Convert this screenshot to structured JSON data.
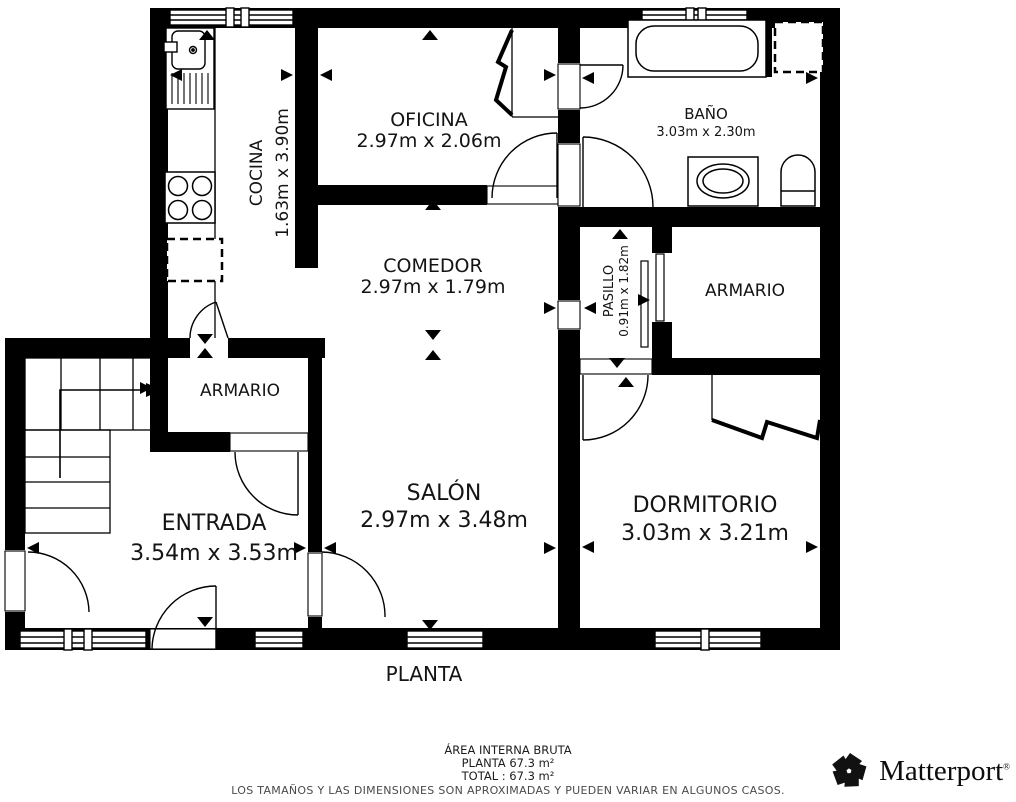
{
  "plan": {
    "title": "PLANTA",
    "rooms": {
      "cocina": {
        "name": "COCINA",
        "dims": "1.63m x 3.90m"
      },
      "oficina": {
        "name": "OFICINA",
        "dims": "2.97m x 2.06m"
      },
      "bano": {
        "name": "BAÑO",
        "dims": "3.03m x 2.30m"
      },
      "comedor": {
        "name": "COMEDOR",
        "dims": "2.97m x 1.79m"
      },
      "pasillo": {
        "name": "PASILLO",
        "dims": "0.91m x 1.82m"
      },
      "armario_superior": {
        "name": "ARMARIO"
      },
      "armario_entrada": {
        "name": "ARMARIO"
      },
      "entrada": {
        "name": "ENTRADA",
        "dims": "3.54m x 3.53m"
      },
      "salon": {
        "name": "SALÓN",
        "dims": "2.97m x 3.48m"
      },
      "dormitorio": {
        "name": "DORMITORIO",
        "dims": "3.03m x 3.21m"
      }
    }
  },
  "footer": {
    "area_label": "ÁREA INTERNA BRUTA",
    "planta_area": "PLANTA 67.3 m²",
    "total_area": "TOTAL :  67.3 m²",
    "disclaimer": "LOS TAMAÑOS Y LAS DIMENSIONES SON APROXIMADAS Y PUEDEN VARIAR EN ALGUNOS CASOS."
  },
  "branding": {
    "logo_text": "Matterport",
    "registered_mark": "®"
  },
  "colors": {
    "wall": "#000000",
    "background": "#ffffff",
    "disclaimer_text": "#4a4a4a"
  }
}
